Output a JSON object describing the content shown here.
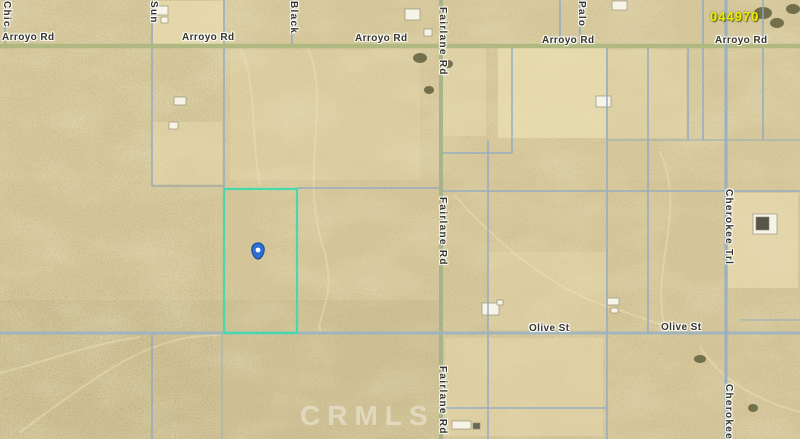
{
  "map": {
    "watermark": "CRMLS",
    "parcel_number_label": "044970",
    "pin": {
      "icon": "location-pin",
      "color": "#2e6fd3"
    },
    "colors": {
      "sand_base": "#d6c79a",
      "road_green": "#aeb77f",
      "parcel_line_blue": "#8da9c4",
      "selected_parcel_teal": "#47d8ac",
      "pin_blue": "#2e6fd3",
      "parcel_number_yellow": "#ecf000",
      "label_text": "#35352b",
      "watermark_white": "#ffffff"
    },
    "labels": [
      {
        "text": "Arroyo Rd"
      },
      {
        "text": "Arroyo Rd"
      },
      {
        "text": "Arroyo Rd"
      },
      {
        "text": "Arroyo Rd"
      },
      {
        "text": "Arroyo Rd"
      },
      {
        "text": "Olive St"
      },
      {
        "text": "Olive St"
      },
      {
        "text": "Fairlane Rd"
      },
      {
        "text": "Fairlane Rd"
      },
      {
        "text": "Fairlane Rd"
      },
      {
        "text": "Sun"
      },
      {
        "text": "Black"
      },
      {
        "text": "Chic"
      },
      {
        "text": "Palo"
      },
      {
        "text": "Cherokee Trl"
      },
      {
        "text": "Cherokee Trl"
      }
    ]
  }
}
